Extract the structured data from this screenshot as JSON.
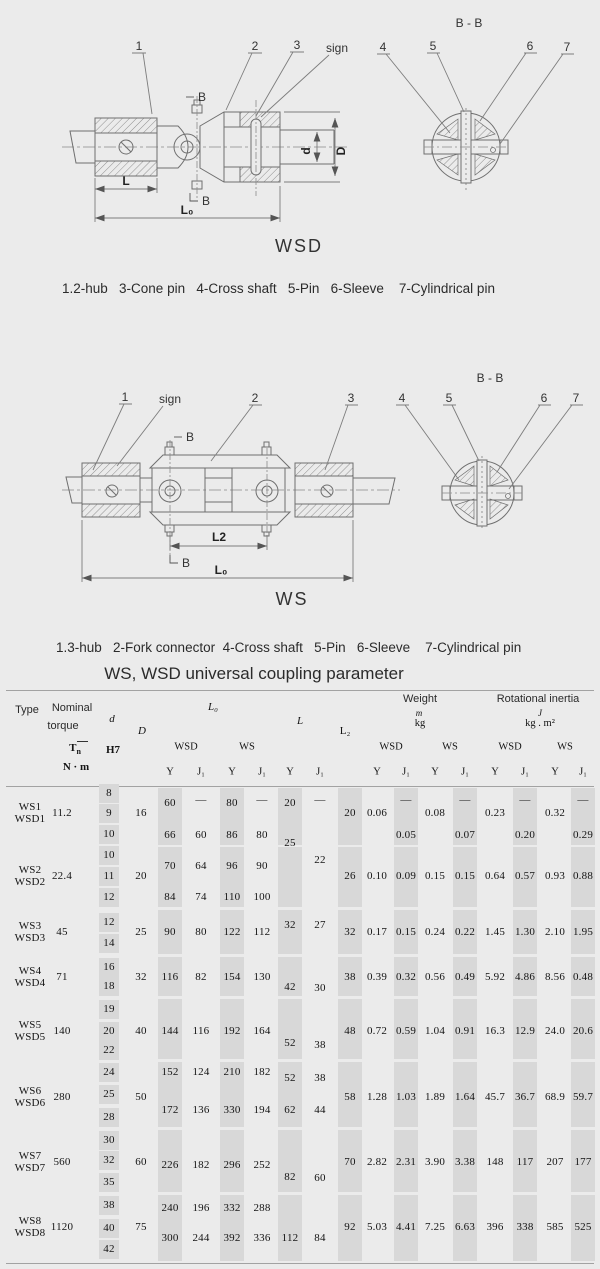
{
  "page": {
    "bg": "#ebebeb",
    "line_color": "#6f6f6f",
    "thin_line": "#7d7d7d"
  },
  "figures": {
    "wsd": {
      "caption": "WSD",
      "section": "B - B",
      "n1": "1",
      "n2": "2",
      "n3": "3",
      "sign": "sign",
      "n4": "4",
      "n5": "5",
      "n6": "6",
      "n7": "7",
      "dim_l": "L",
      "dim_l0": "L₀",
      "dim_b_top": "B",
      "dim_b_bottom": "B",
      "dim_d": "d",
      "dim_D": "D"
    },
    "ws": {
      "caption": "WS",
      "section": "B - B",
      "n1": "1",
      "sign": "sign",
      "n2": "2",
      "n3": "3",
      "n4": "4",
      "n5": "5",
      "n6": "6",
      "n7": "7",
      "dim_l2": "L2",
      "dim_l0": "L₀",
      "dim_b_top": "B",
      "dim_b_bottom": "B"
    }
  },
  "legend_wsd": "1.2-hub   3-Cone pin   4-Cross shaft   5-Pin   6-Sleeve    7-Cylindrical pin",
  "legend_ws": "1.3-hub   2-Fork connector  4-Cross shaft   5-Pin   6-Sleeve    7-Cylindrical pin",
  "table": {
    "title": "WS, WSD universal coupling parameter",
    "colors": {
      "stripe": "#d8d8d8",
      "rule": "#a2a2a2"
    },
    "header": {
      "type": "Type",
      "nominal": "Nominal",
      "torque": "torque",
      "t_main": "T",
      "t_sub": "n",
      "nm": "N · m",
      "d": "d",
      "h7": "H7",
      "D": "D",
      "l0": "L₀",
      "l": "L",
      "l2": "L₂",
      "weight": "Weight",
      "m": "m",
      "kg": "kg",
      "inertia": "Rotational inertia",
      "j": "J",
      "kgm2": "kg . m²",
      "wsd": "WSD",
      "ws": "WS",
      "y": "Y",
      "j1": "J₁"
    },
    "cells": [
      [
        30,
        807,
        "WS1"
      ],
      [
        30,
        819,
        "WSD1"
      ],
      [
        30,
        870,
        "WS2"
      ],
      [
        30,
        882,
        "WSD2"
      ],
      [
        30,
        926,
        "WS3"
      ],
      [
        30,
        938,
        "WSD3"
      ],
      [
        30,
        971,
        "WS4"
      ],
      [
        30,
        983,
        "WSD4"
      ],
      [
        30,
        1025,
        "WS5"
      ],
      [
        30,
        1037,
        "WSD5"
      ],
      [
        30,
        1091,
        "WS6"
      ],
      [
        30,
        1103,
        "WSD6"
      ],
      [
        30,
        1156,
        "WS7"
      ],
      [
        30,
        1168,
        "WSD7"
      ],
      [
        30,
        1221,
        "WS8"
      ],
      [
        30,
        1233,
        "WSD8"
      ],
      [
        62,
        813,
        "11.2"
      ],
      [
        62,
        876,
        "22.4"
      ],
      [
        62,
        932,
        "45"
      ],
      [
        62,
        977,
        "71"
      ],
      [
        62,
        1031,
        "140"
      ],
      [
        62,
        1097,
        "280"
      ],
      [
        62,
        1162,
        "560"
      ],
      [
        62,
        1227,
        "1120"
      ],
      [
        109,
        793,
        "8"
      ],
      [
        109,
        813,
        "9"
      ],
      [
        109,
        834,
        "10"
      ],
      [
        109,
        855,
        "10"
      ],
      [
        109,
        876,
        "11"
      ],
      [
        109,
        897,
        "12"
      ],
      [
        109,
        922,
        "12"
      ],
      [
        109,
        943,
        "14"
      ],
      [
        109,
        967,
        "16"
      ],
      [
        109,
        986,
        "18"
      ],
      [
        109,
        1009,
        "19"
      ],
      [
        109,
        1031,
        "20"
      ],
      [
        109,
        1050,
        "22"
      ],
      [
        109,
        1072,
        "24"
      ],
      [
        109,
        1094,
        "25"
      ],
      [
        109,
        1117,
        "28"
      ],
      [
        109,
        1140,
        "30"
      ],
      [
        109,
        1160,
        "32"
      ],
      [
        109,
        1182,
        "35"
      ],
      [
        109,
        1205,
        "38"
      ],
      [
        109,
        1228,
        "40"
      ],
      [
        109,
        1249,
        "42"
      ],
      [
        141,
        813,
        "16"
      ],
      [
        141,
        876,
        "20"
      ],
      [
        141,
        932,
        "25"
      ],
      [
        141,
        977,
        "32"
      ],
      [
        141,
        1031,
        "40"
      ],
      [
        141,
        1097,
        "50"
      ],
      [
        141,
        1162,
        "60"
      ],
      [
        141,
        1227,
        "75"
      ],
      [
        170,
        803,
        "60"
      ],
      [
        170,
        835,
        "66"
      ],
      [
        170,
        866,
        "70"
      ],
      [
        170,
        897,
        "84"
      ],
      [
        170,
        932,
        "90"
      ],
      [
        170,
        977,
        "116"
      ],
      [
        170,
        1031,
        "144"
      ],
      [
        170,
        1072,
        "152"
      ],
      [
        170,
        1110,
        "172"
      ],
      [
        170,
        1165,
        "226"
      ],
      [
        170,
        1208,
        "240"
      ],
      [
        170,
        1238,
        "300"
      ],
      [
        201,
        800,
        "—"
      ],
      [
        201,
        835,
        "60"
      ],
      [
        201,
        866,
        "64"
      ],
      [
        201,
        897,
        "74"
      ],
      [
        201,
        932,
        "80"
      ],
      [
        201,
        977,
        "82"
      ],
      [
        201,
        1031,
        "116"
      ],
      [
        201,
        1072,
        "124"
      ],
      [
        201,
        1110,
        "136"
      ],
      [
        201,
        1165,
        "182"
      ],
      [
        201,
        1208,
        "196"
      ],
      [
        201,
        1238,
        "244"
      ],
      [
        232,
        803,
        "80"
      ],
      [
        232,
        835,
        "86"
      ],
      [
        232,
        866,
        "96"
      ],
      [
        232,
        897,
        "110"
      ],
      [
        232,
        932,
        "122"
      ],
      [
        232,
        977,
        "154"
      ],
      [
        232,
        1031,
        "192"
      ],
      [
        232,
        1072,
        "210"
      ],
      [
        232,
        1110,
        "330"
      ],
      [
        232,
        1165,
        "296"
      ],
      [
        232,
        1208,
        "332"
      ],
      [
        232,
        1238,
        "392"
      ],
      [
        262,
        800,
        "—"
      ],
      [
        262,
        835,
        "80"
      ],
      [
        262,
        866,
        "90"
      ],
      [
        262,
        897,
        "100"
      ],
      [
        262,
        932,
        "112"
      ],
      [
        262,
        977,
        "130"
      ],
      [
        262,
        1031,
        "164"
      ],
      [
        262,
        1072,
        "182"
      ],
      [
        262,
        1110,
        "194"
      ],
      [
        262,
        1165,
        "252"
      ],
      [
        262,
        1208,
        "288"
      ],
      [
        262,
        1238,
        "336"
      ],
      [
        290,
        803,
        "20"
      ],
      [
        290,
        843,
        "25"
      ],
      [
        290,
        925,
        "32"
      ],
      [
        290,
        987,
        "42"
      ],
      [
        290,
        1043,
        "52"
      ],
      [
        290,
        1078,
        "52"
      ],
      [
        290,
        1110,
        "62"
      ],
      [
        290,
        1177,
        "82"
      ],
      [
        290,
        1238,
        "112"
      ],
      [
        320,
        800,
        "—"
      ],
      [
        320,
        860,
        "22"
      ],
      [
        320,
        925,
        "27"
      ],
      [
        320,
        988,
        "30"
      ],
      [
        320,
        1045,
        "38"
      ],
      [
        320,
        1078,
        "38"
      ],
      [
        320,
        1110,
        "44"
      ],
      [
        320,
        1178,
        "60"
      ],
      [
        320,
        1238,
        "84"
      ],
      [
        350,
        813,
        "20"
      ],
      [
        350,
        876,
        "26"
      ],
      [
        350,
        932,
        "32"
      ],
      [
        350,
        977,
        "38"
      ],
      [
        350,
        1031,
        "48"
      ],
      [
        350,
        1097,
        "58"
      ],
      [
        350,
        1162,
        "70"
      ],
      [
        350,
        1227,
        "92"
      ],
      [
        377,
        813,
        "0.06"
      ],
      [
        377,
        876,
        "0.10"
      ],
      [
        377,
        932,
        "0.17"
      ],
      [
        377,
        977,
        "0.39"
      ],
      [
        377,
        1031,
        "0.72"
      ],
      [
        377,
        1097,
        "1.28"
      ],
      [
        377,
        1162,
        "2.82"
      ],
      [
        377,
        1227,
        "5.03"
      ],
      [
        406,
        800,
        "—"
      ],
      [
        406,
        835,
        "0.05"
      ],
      [
        406,
        876,
        "0.09"
      ],
      [
        406,
        932,
        "0.15"
      ],
      [
        406,
        977,
        "0.32"
      ],
      [
        406,
        1031,
        "0.59"
      ],
      [
        406,
        1097,
        "1.03"
      ],
      [
        406,
        1162,
        "2.31"
      ],
      [
        406,
        1227,
        "4.41"
      ],
      [
        435,
        813,
        "0.08"
      ],
      [
        435,
        876,
        "0.15"
      ],
      [
        435,
        932,
        "0.24"
      ],
      [
        435,
        977,
        "0.56"
      ],
      [
        435,
        1031,
        "1.04"
      ],
      [
        435,
        1097,
        "1.89"
      ],
      [
        435,
        1162,
        "3.90"
      ],
      [
        435,
        1227,
        "7.25"
      ],
      [
        465,
        800,
        "—"
      ],
      [
        465,
        835,
        "0.07"
      ],
      [
        465,
        876,
        "0.15"
      ],
      [
        465,
        932,
        "0.22"
      ],
      [
        465,
        977,
        "0.49"
      ],
      [
        465,
        1031,
        "0.91"
      ],
      [
        465,
        1097,
        "1.64"
      ],
      [
        465,
        1162,
        "3.38"
      ],
      [
        465,
        1227,
        "6.63"
      ],
      [
        495,
        813,
        "0.23"
      ],
      [
        495,
        876,
        "0.64"
      ],
      [
        495,
        932,
        "1.45"
      ],
      [
        495,
        977,
        "5.92"
      ],
      [
        495,
        1031,
        "16.3"
      ],
      [
        495,
        1097,
        "45.7"
      ],
      [
        495,
        1162,
        "148"
      ],
      [
        495,
        1227,
        "396"
      ],
      [
        525,
        800,
        "—"
      ],
      [
        525,
        835,
        "0.20"
      ],
      [
        525,
        876,
        "0.57"
      ],
      [
        525,
        932,
        "1.30"
      ],
      [
        525,
        977,
        "4.86"
      ],
      [
        525,
        1031,
        "12.9"
      ],
      [
        525,
        1097,
        "36.7"
      ],
      [
        525,
        1162,
        "117"
      ],
      [
        525,
        1227,
        "338"
      ],
      [
        555,
        813,
        "0.32"
      ],
      [
        555,
        876,
        "0.93"
      ],
      [
        555,
        932,
        "2.10"
      ],
      [
        555,
        977,
        "8.56"
      ],
      [
        555,
        1031,
        "24.0"
      ],
      [
        555,
        1097,
        "68.9"
      ],
      [
        555,
        1162,
        "207"
      ],
      [
        555,
        1227,
        "585"
      ],
      [
        583,
        800,
        "—"
      ],
      [
        583,
        835,
        "0.29"
      ],
      [
        583,
        876,
        "0.88"
      ],
      [
        583,
        932,
        "1.95"
      ],
      [
        583,
        977,
        "0.48"
      ],
      [
        583,
        1031,
        "20.6"
      ],
      [
        583,
        1097,
        "59.7"
      ],
      [
        583,
        1162,
        "177"
      ],
      [
        583,
        1227,
        "525"
      ]
    ]
  }
}
